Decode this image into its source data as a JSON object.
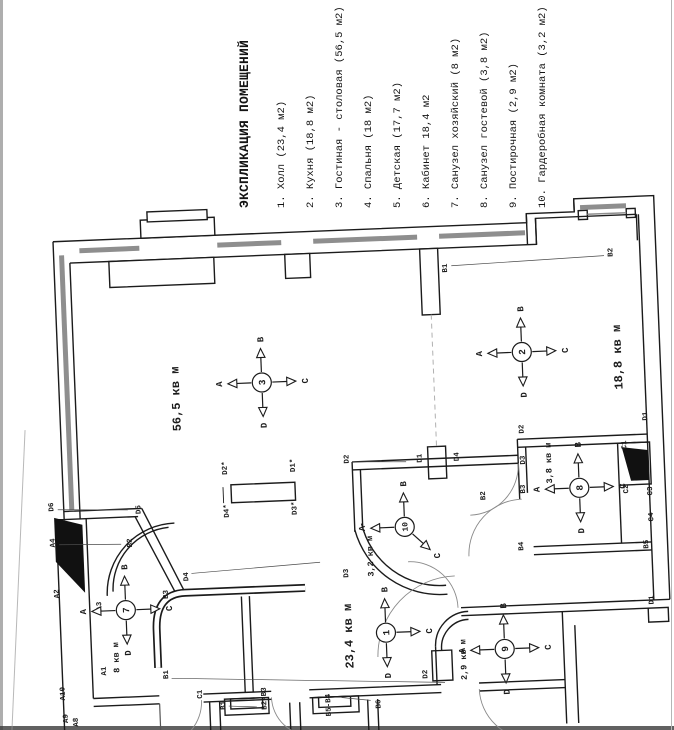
{
  "legend": {
    "title": "ЭКСПЛИКАЦИЯ ПОМЕЩЕНИЙ",
    "items": [
      "1. Холл (23,4 м2)",
      "2. Кухня (18,8 м2)",
      "3. Гостиная - столовая (56,5 м2)",
      "4. Спальня (18 м2)",
      "5. Детская (17,7 м2)",
      "6. Кабинет 18,4 м2",
      "7. Санузел хозяйский (8 м2)",
      "8. Санузел гостевой (3,8 м2)",
      "9. Постирочная (2,9 м2)",
      "10. Гардеробная комната (3,2 м2)"
    ]
  },
  "plan": {
    "area_labels": [
      {
        "t": "56,5 кв м",
        "x": 178,
        "y": 392,
        "s": 12
      },
      {
        "t": "18,8 кв м",
        "x": 621,
        "y": 368,
        "s": 12
      },
      {
        "t": "23,4 кв м",
        "x": 341,
        "y": 636,
        "s": 12
      },
      {
        "t": "3,2 кв м",
        "x": 366,
        "y": 557,
        "s": 8.5
      },
      {
        "t": "8 кв м",
        "x": 108,
        "y": 648,
        "s": 8.5
      },
      {
        "t": "3,8 кв м",
        "x": 548,
        "y": 471,
        "s": 8.5
      },
      {
        "t": "2,9 кв м",
        "x": 455,
        "y": 664,
        "s": 8.5
      }
    ],
    "wall_labels": [
      {
        "t": "B1",
        "x": 452,
        "y": 272,
        "leader": [
          459,
          270,
          612,
          266
        ]
      },
      {
        "t": "B2",
        "x": 618,
        "y": 263
      },
      {
        "t": "D2",
        "x": 346,
        "y": 459,
        "leader": [
          352,
          462,
          406,
          464
        ]
      },
      {
        "t": "D1",
        "x": 419,
        "y": 461
      },
      {
        "t": "D4",
        "x": 456,
        "y": 461
      },
      {
        "t": "B2",
        "x": 481,
        "y": 501
      },
      {
        "t": "D3",
        "x": 341,
        "y": 573
      },
      {
        "t": "D1",
        "x": 646,
        "y": 428
      },
      {
        "t": "D2",
        "x": 522,
        "y": 436
      },
      {
        "t": "D3",
        "x": 522,
        "y": 467
      },
      {
        "t": "B3",
        "x": 521,
        "y": 496
      },
      {
        "t": "B4",
        "x": 517,
        "y": 553
      },
      {
        "t": "C1",
        "x": 624,
        "y": 456
      },
      {
        "t": "C2",
        "x": 624,
        "y": 500
      },
      {
        "t": "C3",
        "x": 648,
        "y": 503
      },
      {
        "t": "C4",
        "x": 648,
        "y": 529
      },
      {
        "t": "B5",
        "x": 642,
        "y": 556
      },
      {
        "t": "D1",
        "x": 645,
        "y": 612
      },
      {
        "t": "D2",
        "x": 416,
        "y": 677
      },
      {
        "t": "D6",
        "x": 49,
        "y": 495,
        "leader": [
          56,
          498,
          126,
          501
        ]
      },
      {
        "t": "D5",
        "x": 136,
        "y": 501
      },
      {
        "t": "A4",
        "x": 49,
        "y": 531,
        "leader": [
          56,
          533,
          118,
          535
        ]
      },
      {
        "t": "B2",
        "x": 126,
        "y": 534
      },
      {
        "t": "A2",
        "x": 51,
        "y": 582
      },
      {
        "t": "A3",
        "x": 93,
        "y": 596
      },
      {
        "t": "B3",
        "x": 160,
        "y": 587
      },
      {
        "t": "D4",
        "x": 181,
        "y": 570,
        "leader": [
          187,
          567,
          316,
          561
        ]
      },
      {
        "t": "A1",
        "x": 95,
        "y": 661
      },
      {
        "t": "A10",
        "x": 53,
        "y": 682
      },
      {
        "t": "A9",
        "x": 55,
        "y": 707
      },
      {
        "t": "A8",
        "x": 65,
        "y": 711
      },
      {
        "t": "B1",
        "x": 157,
        "y": 667,
        "leader": [
          163,
          671,
          436,
          686
        ]
      },
      {
        "t": "C1",
        "x": 190,
        "y": 688
      },
      {
        "t": "B1",
        "x": 213,
        "y": 700,
        "leader": [
          219,
          701,
          247,
          703
        ]
      },
      {
        "t": "B2-B3",
        "x": 254,
        "y": 695
      },
      {
        "t": "B5-B4",
        "x": 318,
        "y": 704
      },
      {
        "t": "B6",
        "x": 368,
        "y": 705,
        "leader": [
          361,
          701,
          332,
          697
        ]
      },
      {
        "t": "D2*",
        "x": 224,
        "y": 463
      },
      {
        "t": "D1*",
        "x": 292,
        "y": 463
      },
      {
        "t": "D4*",
        "x": 224,
        "y": 506
      },
      {
        "t": "D3*",
        "x": 292,
        "y": 506
      }
    ],
    "compasses": [
      {
        "n": "3",
        "x": 265,
        "y": 379,
        "arms": [
          [
            "left",
            "A"
          ],
          [
            "up",
            "B"
          ],
          [
            "right",
            "C"
          ],
          [
            "down",
            "D"
          ]
        ]
      },
      {
        "n": "2",
        "x": 526,
        "y": 359,
        "arms": [
          [
            "left",
            "A"
          ],
          [
            "up",
            "B"
          ],
          [
            "right",
            "C"
          ],
          [
            "down",
            "D"
          ]
        ]
      },
      {
        "n": "10",
        "x": 402,
        "y": 529,
        "arms": [
          [
            "left",
            "A"
          ],
          [
            "up",
            "B"
          ],
          [
            "downright",
            "C"
          ]
        ]
      },
      {
        "n": "1",
        "x": 379,
        "y": 634,
        "arms": [
          [
            "up",
            "B"
          ],
          [
            "right",
            "C"
          ],
          [
            "down",
            "D"
          ]
        ]
      },
      {
        "n": "7",
        "x": 120,
        "y": 601,
        "arms": [
          [
            "left",
            "A"
          ],
          [
            "up",
            "B"
          ],
          [
            "right",
            "C"
          ],
          [
            "down",
            "D"
          ]
        ]
      },
      {
        "n": "8",
        "x": 578,
        "y": 497,
        "arms": [
          [
            "left",
            "A"
          ],
          [
            "up",
            "B"
          ],
          [
            "right",
            "C"
          ],
          [
            "down",
            "D"
          ]
        ]
      },
      {
        "n": "9",
        "x": 497,
        "y": 655,
        "arms": [
          [
            "left",
            "A"
          ],
          [
            "up",
            "B"
          ],
          [
            "right",
            "C"
          ],
          [
            "down",
            "D"
          ]
        ]
      }
    ]
  },
  "colors": {
    "ink": "#1b1b1b",
    "paper": "#ffffff",
    "window_gray": "#8e8e8e"
  }
}
